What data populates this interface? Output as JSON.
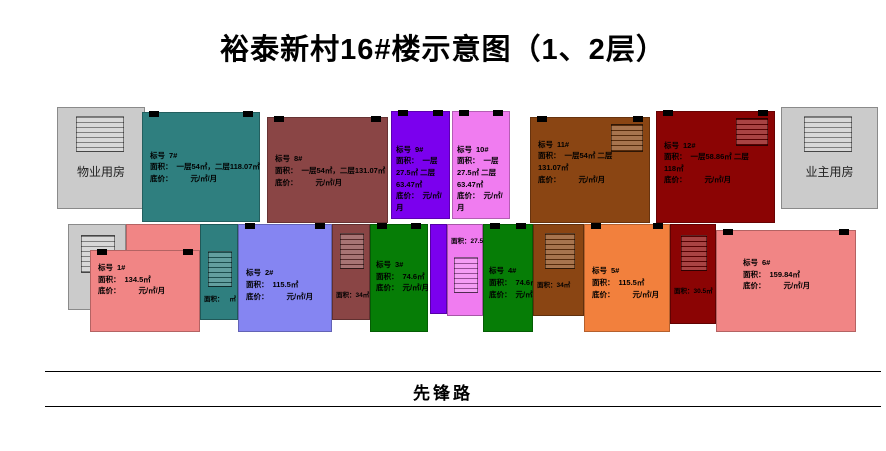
{
  "title": "裕泰新村16#楼示意图（1、2层）",
  "road_label": "先锋路",
  "labels": {
    "biaohao": "标号",
    "mianji": "面积：",
    "dijia": "底价：",
    "price": "元/㎡/月"
  },
  "rooms": {
    "left": "物业用房",
    "right": "业主用房"
  },
  "units": {
    "u7": {
      "num": "7#",
      "area": "一层54㎡，二层118.07㎡",
      "color": "#2f7f7f"
    },
    "u8": {
      "num": "8#",
      "area": "一层54㎡，二层131.07㎡",
      "color": "#8a4545"
    },
    "u9": {
      "num": "9#",
      "area": "一层27.5㎡ 二层63.47㎡",
      "color": "#7b00ee"
    },
    "u10": {
      "num": "10#",
      "area": "一层27.5㎡ 二层63.47㎡",
      "color": "#f07cf0"
    },
    "u11": {
      "num": "11#",
      "area": "一层54㎡ 二层131.07㎡",
      "color": "#8a4513"
    },
    "u12": {
      "num": "12#",
      "area": "一层58.86㎡ 二层118㎡",
      "color": "#8b0404"
    },
    "u1": {
      "num": "1#",
      "area": "134.5㎡",
      "color": "#f18585"
    },
    "u2": {
      "num": "2#",
      "area": "115.5㎡",
      "color": "#8585f2"
    },
    "u3": {
      "num": "3#",
      "area": "74.6㎡",
      "color": "#067d06"
    },
    "u4": {
      "num": "4#",
      "area": "74.6㎡",
      "color": "#067d06"
    },
    "u5": {
      "num": "5#",
      "area": "115.5㎡",
      "color": "#f2803d"
    },
    "u6": {
      "num": "6#",
      "area": "159.84㎡",
      "color": "#f18585"
    }
  },
  "strips": {
    "teal": {
      "area_label": "面积：",
      "area": "㎡",
      "color": "#2f7f7f"
    },
    "maroon": {
      "area_label": "面积：",
      "area": "34㎡",
      "color": "#8a4545"
    },
    "pink": {
      "area_label": "面积：",
      "area": "27.5㎡",
      "color": "#f07cf0"
    },
    "brown": {
      "area_label": "面积：",
      "area": "34㎡",
      "color": "#8a4513"
    },
    "red": {
      "area_label": "面积：",
      "area": "30.5㎡",
      "color": "#8b0404"
    },
    "violet": {
      "color": "#7b00ee"
    }
  }
}
